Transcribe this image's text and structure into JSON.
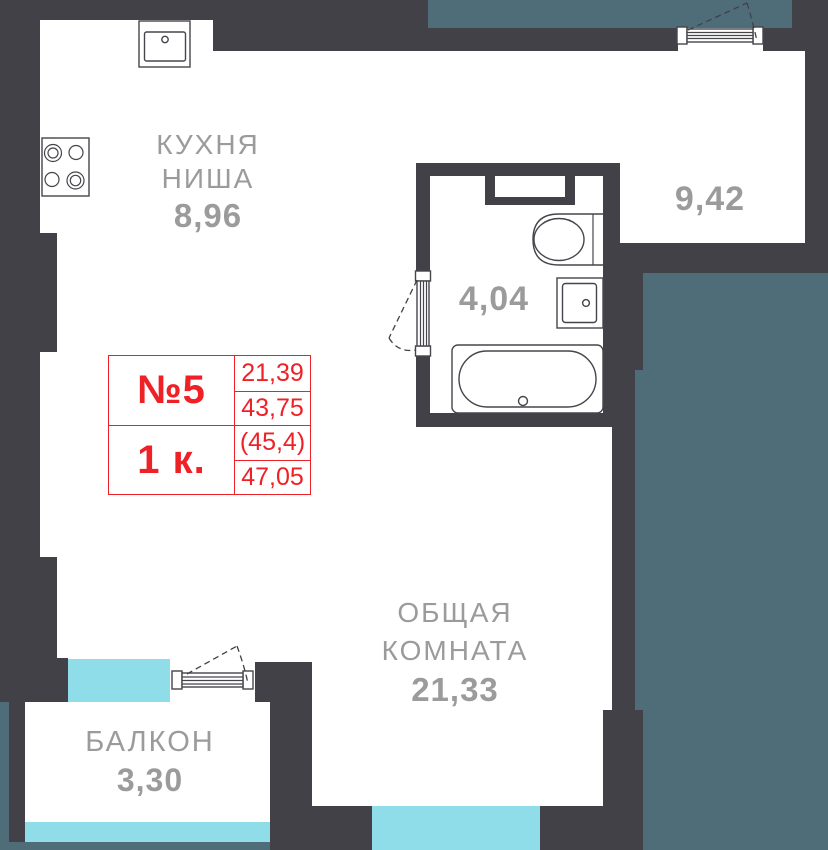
{
  "rooms": {
    "kitchen": {
      "line1": "КУХНЯ",
      "line2": "НИША",
      "area": "8,96"
    },
    "second_room": {
      "area": "9,42"
    },
    "bathroom": {
      "area": "4,04"
    },
    "living_room": {
      "line1": "ОБЩАЯ",
      "line2": "КОМНАТА",
      "area": "21,33"
    },
    "balcony": {
      "name": "БАЛКОН",
      "area": "3,30"
    }
  },
  "info_table": {
    "unit_number": "№5",
    "room_count": "1 к.",
    "living_area": "21,39",
    "area_without_balcony": "43,75",
    "area_with_coeff": "(45,4)",
    "total_area": "47,05"
  },
  "colors": {
    "wall": "#414147",
    "adjacent_unit": "#4f6d79",
    "glazing": "#8edde9",
    "label_text": "#9b9b9b",
    "accent_red": "#ee2127"
  }
}
